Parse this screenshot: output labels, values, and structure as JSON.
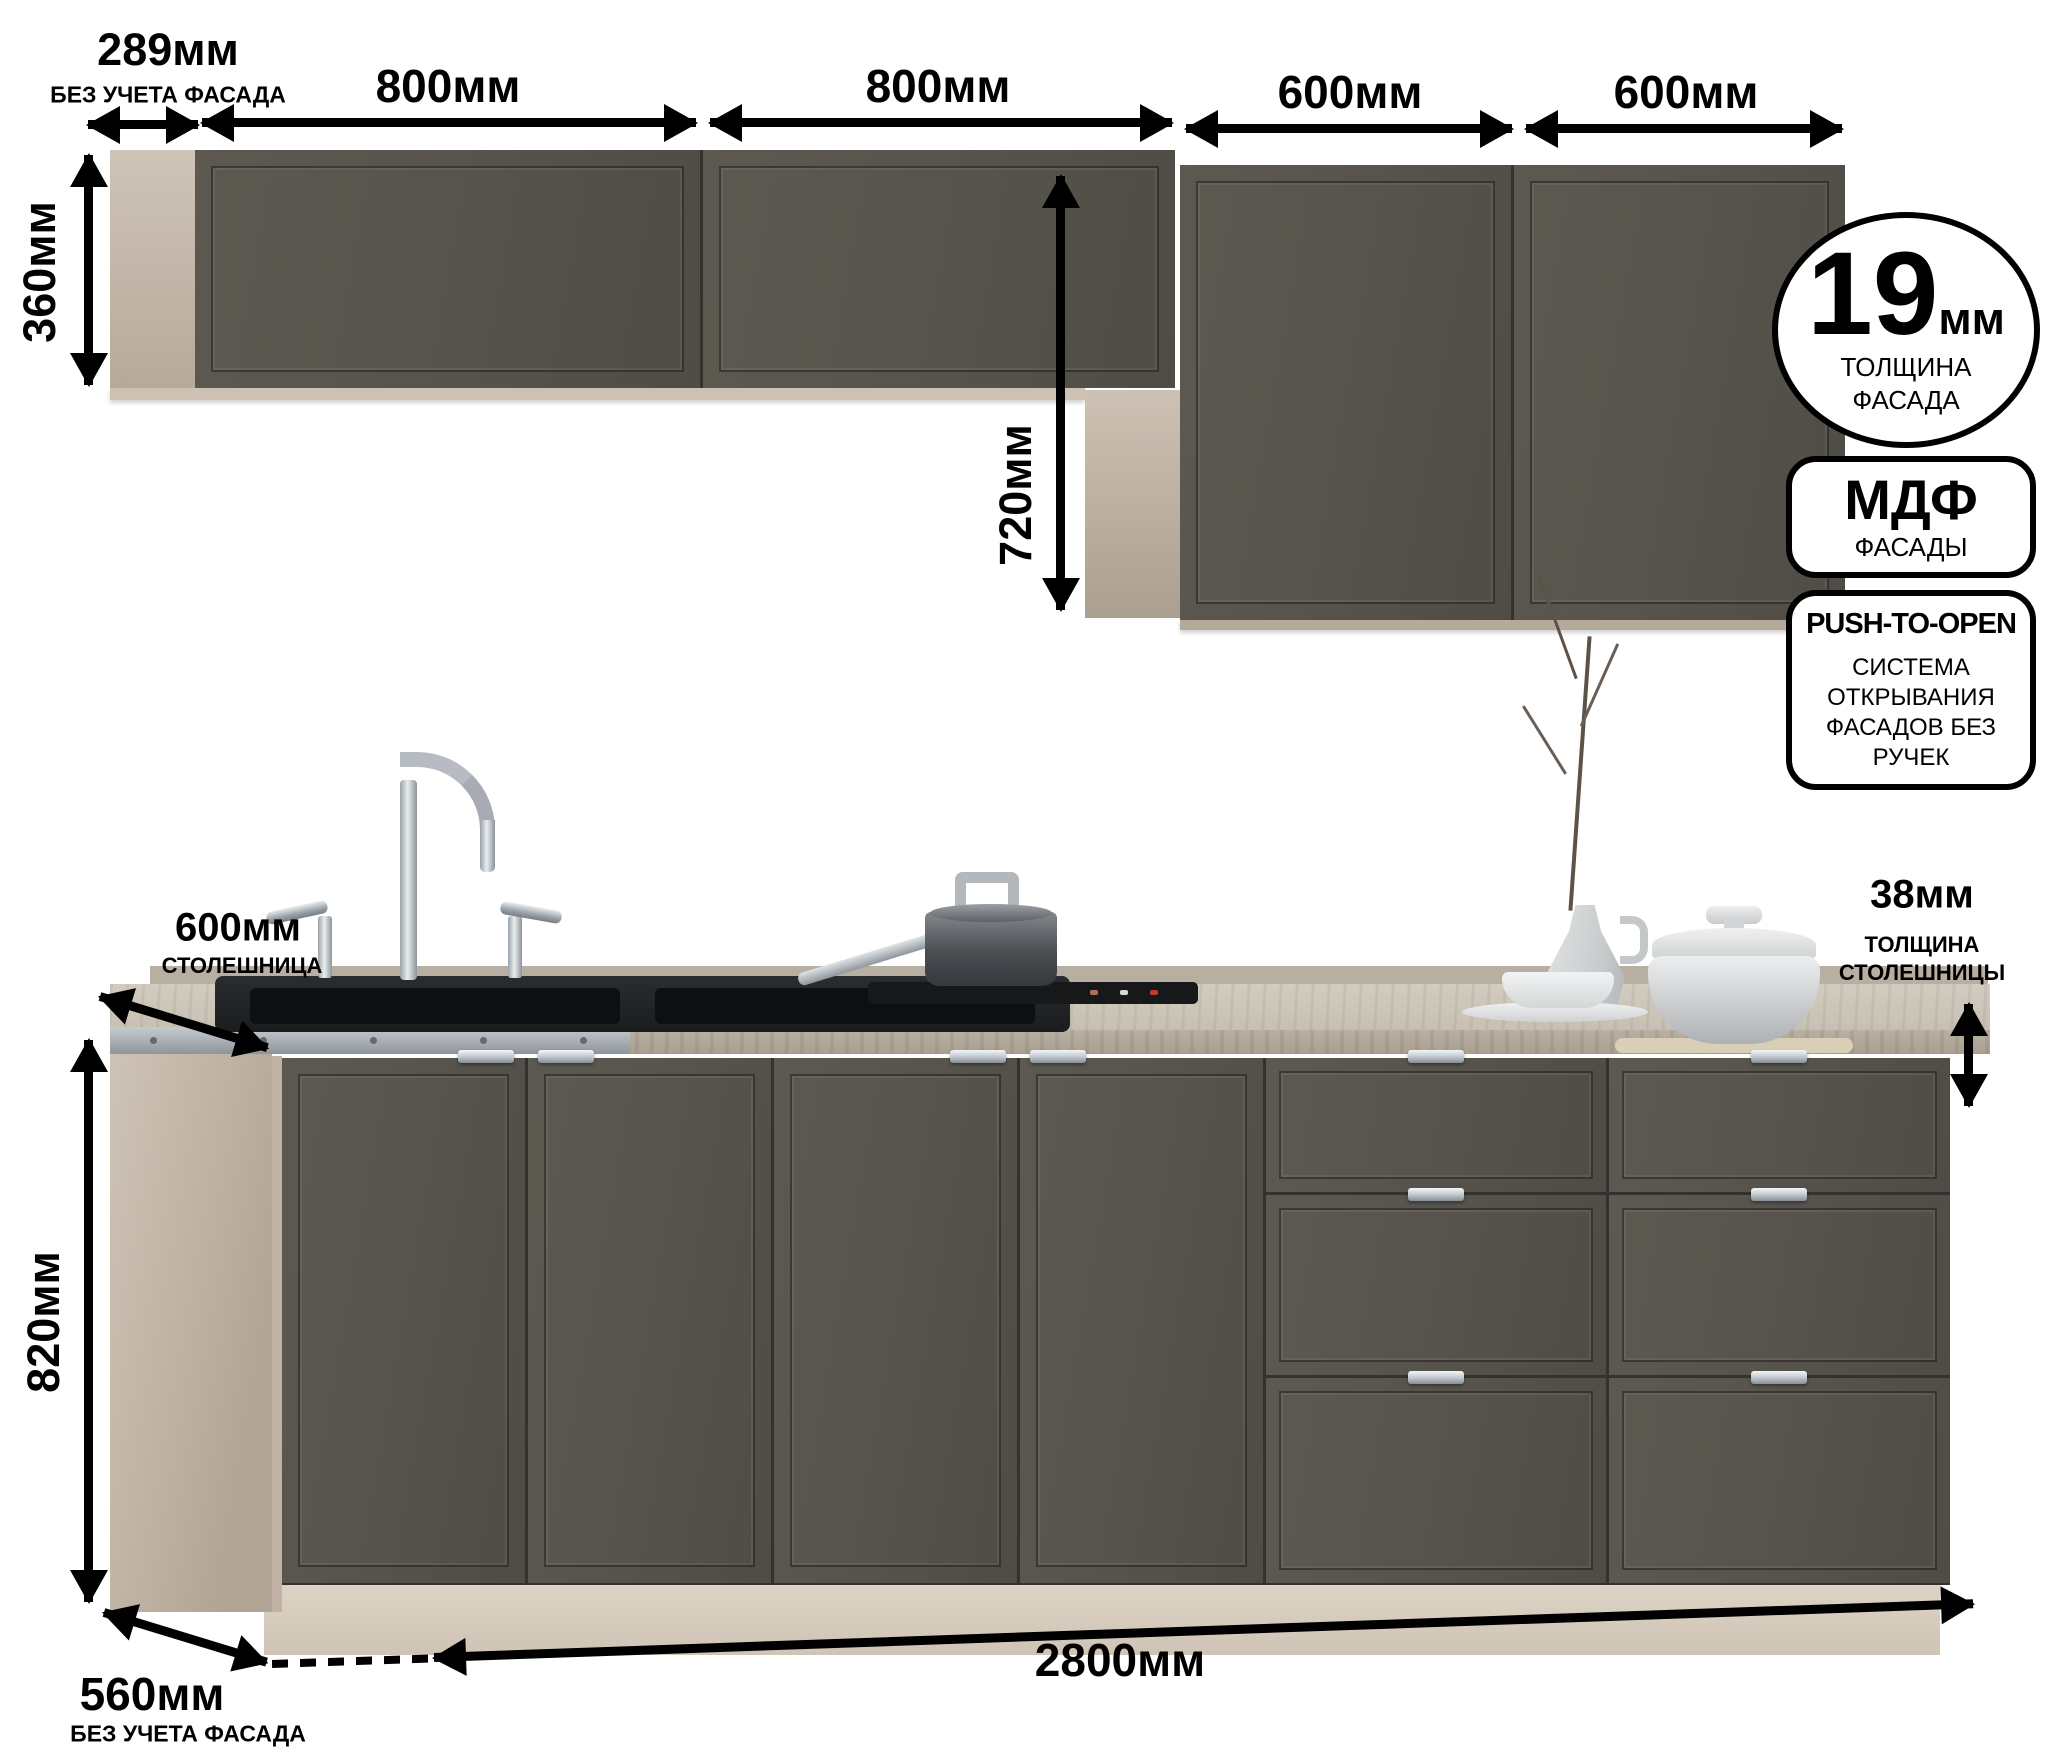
{
  "wall_section": {
    "dims": {
      "side_depth": {
        "value": "289мм",
        "note": "БЕЗ УЧЕТА ФАСАДА"
      },
      "cabinet1_width": "800мм",
      "cabinet2_width": "800мм",
      "cabinet3_width": "600мм",
      "cabinet4_width": "600мм",
      "short_height": "360мм",
      "tall_height": "720мм"
    }
  },
  "badges": {
    "facade_thickness": {
      "number": "19",
      "unit": "мм",
      "caption_line1": "ТОЛЩИНА",
      "caption_line2": "ФАСАДА"
    },
    "material": {
      "name": "МДФ",
      "caption": "ФАСАДЫ"
    },
    "opening_system": {
      "name": "PUSH-TO-OPEN",
      "caption": "СИСТЕМА ОТКРЫВАНИЯ ФАСАДОВ БЕЗ РУЧЕК"
    }
  },
  "base_section": {
    "dims": {
      "countertop_depth": {
        "value": "600мм",
        "note": "СТОЛЕШНИЦА"
      },
      "countertop_thickness": {
        "value": "38мм",
        "note_line1": "ТОЛЩИНА",
        "note_line2": "СТОЛЕШНИЦЫ"
      },
      "base_height": "820мм",
      "base_depth": {
        "value": "560мм",
        "note": "БЕЗ УЧЕТА ФАСАДА"
      },
      "total_width": "2800мм"
    }
  },
  "colors": {
    "facade": "#56534c",
    "carcass": "#c9bdb0",
    "plinth": "#d7ccbe",
    "countertop": "#ccc5b8",
    "annotation": "#000000"
  }
}
